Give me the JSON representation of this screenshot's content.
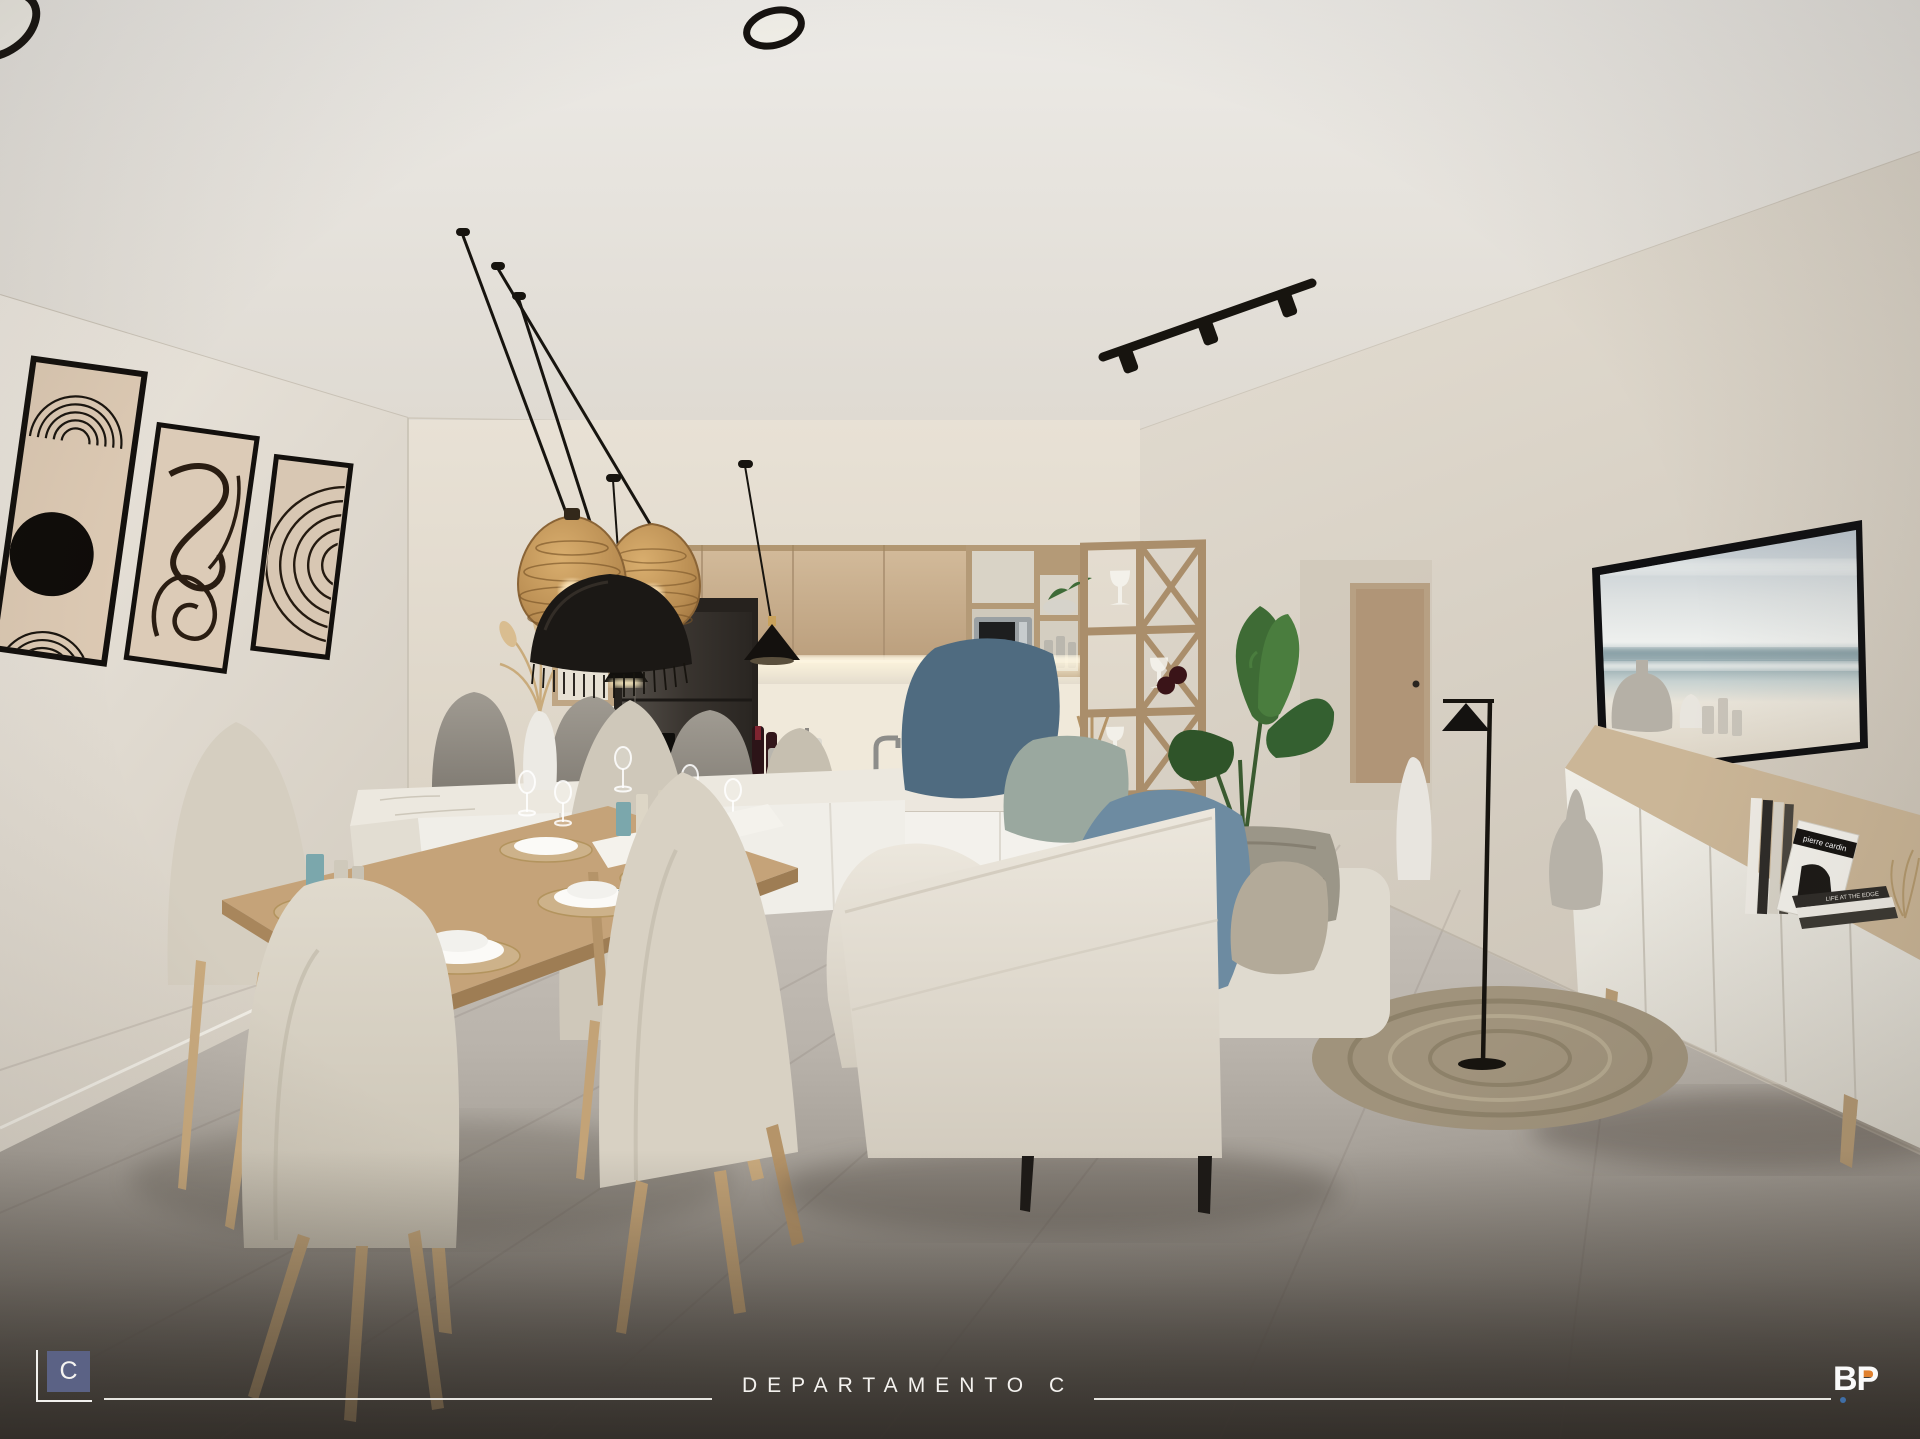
{
  "image_type": "interior-architectural-render",
  "scene_label": "open plan living-dining-kitchen apartment",
  "footer": {
    "project_logo_letter": "C",
    "title": "DEPARTAMENTO C",
    "brand_logo_text": "BP"
  },
  "decor_text": {
    "book_cover_title": "pierre cardin",
    "book_spine_title": "LIFE AT THE EDGE"
  },
  "palette": {
    "ceiling": "#e9e6e1",
    "wall": "#e2dcd2",
    "floor_light": "#c6c0b8",
    "floor_dark": "#55504a",
    "cabinet_wood": "#c4ab8a",
    "rack_wood": "#aa8e6b",
    "island_white": "#efece5",
    "sofa_cream": "#e6e1d6",
    "pillow_navy": "#4f6b80",
    "pillow_blue": "#6d8ba1",
    "candle_teal": "#7ba7ac",
    "plant_green": "#3e6b35",
    "tv_frame": "#111113",
    "logo_blue": "#5b6285",
    "logo_orange": "#e0812f",
    "logo_dot_blue": "#3f6ea6"
  }
}
